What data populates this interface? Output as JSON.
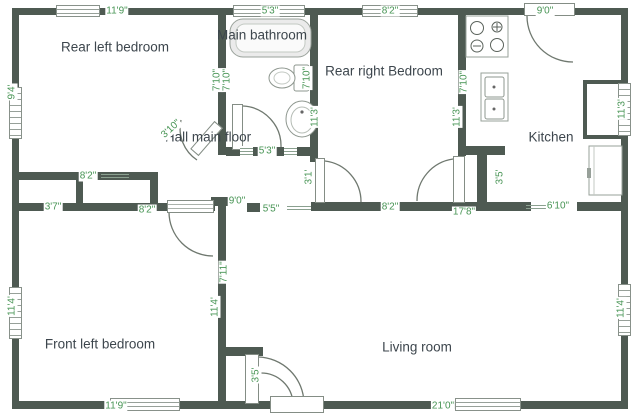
{
  "colors": {
    "wall": "#4e5a52",
    "dimension_text": "#479454",
    "room_text": "#3d464d",
    "fixture_stroke": "#8e978f",
    "door_arc": "#6f786f"
  },
  "rooms": [
    {
      "name": "Rear left bedroom",
      "x": 115,
      "y": 47
    },
    {
      "name": "Main bathroom",
      "x": 262,
      "y": 35
    },
    {
      "name": "Rear right Bedroom",
      "x": 384,
      "y": 71
    },
    {
      "name": "Kitchen",
      "x": 551,
      "y": 137
    },
    {
      "name": "Hall main floor",
      "x": 208,
      "y": 137
    },
    {
      "name": "Front left bedroom",
      "x": 100,
      "y": 344
    },
    {
      "name": "Living room",
      "x": 417,
      "y": 347
    }
  ],
  "dimensions": [
    {
      "text": "11'9\"",
      "x": 117,
      "y": 11,
      "rot": 0
    },
    {
      "text": "5'3\"",
      "x": 270,
      "y": 11,
      "rot": 0
    },
    {
      "text": "8'2\"",
      "x": 390,
      "y": 11,
      "rot": 0
    },
    {
      "text": "9'0\"",
      "x": 545,
      "y": 11,
      "rot": 0
    },
    {
      "text": "8'2\"",
      "x": 88,
      "y": 176,
      "rot": 0
    },
    {
      "text": "5'3\"",
      "x": 267,
      "y": 151,
      "rot": 0
    },
    {
      "text": "3'7\"",
      "x": 53,
      "y": 207,
      "rot": 0
    },
    {
      "text": "8'2\"",
      "x": 147,
      "y": 210,
      "rot": 0
    },
    {
      "text": "9'0\"",
      "x": 237,
      "y": 201,
      "rot": 0
    },
    {
      "text": "5'5\"",
      "x": 271,
      "y": 209,
      "rot": 0
    },
    {
      "text": "8'2\"",
      "x": 390,
      "y": 207,
      "rot": 0
    },
    {
      "text": "17'8\"",
      "x": 464,
      "y": 212,
      "rot": 0
    },
    {
      "text": "6'10\"",
      "x": 558,
      "y": 206,
      "rot": 0
    },
    {
      "text": "11'9\"",
      "x": 116,
      "y": 406,
      "rot": 0
    },
    {
      "text": "21'0\"",
      "x": 443,
      "y": 406,
      "rot": 0
    },
    {
      "text": "3'10\"",
      "x": 171,
      "y": 129,
      "rot": -42
    },
    {
      "text": "9'4'",
      "x": 12,
      "y": 92,
      "rot": -90
    },
    {
      "text": "11'4'",
      "x": 12,
      "y": 306,
      "rot": -90
    },
    {
      "text": "7'10\"",
      "x": 217,
      "y": 80,
      "rot": -90
    },
    {
      "text": "7'10\"",
      "x": 227,
      "y": 80,
      "rot": -90
    },
    {
      "text": "7'10\"",
      "x": 307,
      "y": 78,
      "rot": -90
    },
    {
      "text": "11'3'",
      "x": 315,
      "y": 117,
      "rot": -90
    },
    {
      "text": "3'1'",
      "x": 309,
      "y": 177,
      "rot": -90
    },
    {
      "text": "7'10\"",
      "x": 464,
      "y": 82,
      "rot": -90
    },
    {
      "text": "11'3'",
      "x": 457,
      "y": 117,
      "rot": -90
    },
    {
      "text": "3'5'",
      "x": 500,
      "y": 177,
      "rot": -90
    },
    {
      "text": "11'3'",
      "x": 622,
      "y": 109,
      "rot": -90
    },
    {
      "text": "7'11\"",
      "x": 224,
      "y": 272,
      "rot": -90
    },
    {
      "text": "11'4'",
      "x": 215,
      "y": 307,
      "rot": -90
    },
    {
      "text": "3'5'",
      "x": 256,
      "y": 375,
      "rot": -90
    },
    {
      "text": "11'4'",
      "x": 621,
      "y": 308,
      "rot": -90
    }
  ],
  "fixtures": [
    {
      "name": "bathtub"
    },
    {
      "name": "toilet"
    },
    {
      "name": "bathroom-sink"
    },
    {
      "name": "stove"
    },
    {
      "name": "kitchen-sink"
    },
    {
      "name": "refrigerator-counter"
    }
  ]
}
